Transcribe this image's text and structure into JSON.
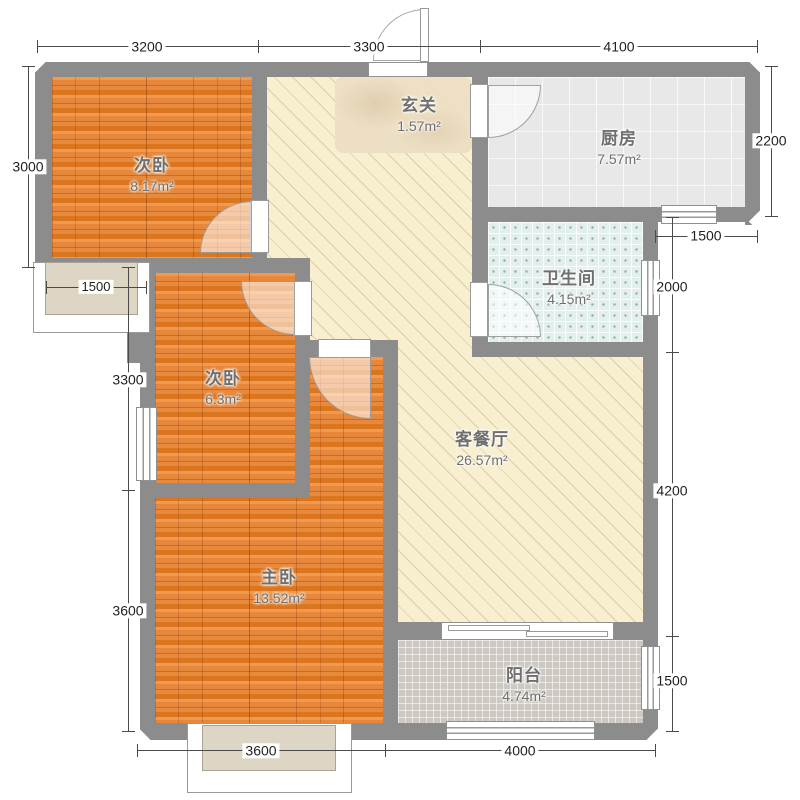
{
  "rooms": {
    "bedroom1": {
      "name": "次卧",
      "area": "8.17m²"
    },
    "hallway": {
      "name": "玄关",
      "area": "1.57m²"
    },
    "kitchen": {
      "name": "厨房",
      "area": "7.57m²"
    },
    "bathroom": {
      "name": "卫生间",
      "area": "4.15m²"
    },
    "bedroom2": {
      "name": "次卧",
      "area": "6.3m²"
    },
    "living": {
      "name": "客餐厅",
      "area": "26.57m²"
    },
    "master": {
      "name": "主卧",
      "area": "13.52m²"
    },
    "balcony": {
      "name": "阳台",
      "area": "4.74m²"
    }
  },
  "dimensions": {
    "top": [
      "3200",
      "3300",
      "4100"
    ],
    "left": [
      "3000",
      "3300",
      "3600"
    ],
    "right_kitchen": [
      "2200",
      "1500"
    ],
    "right": [
      "2000",
      "4200",
      "1500"
    ],
    "bottom": [
      "3600",
      "4000"
    ],
    "bay_window": [
      "1500"
    ]
  },
  "colors": {
    "wall": "#8c8c8c",
    "wood_floor": "#e0822f",
    "living_floor": "#f7efcf",
    "kitchen_tile": "#e8e8e8",
    "bath_tile": "#e3efed",
    "balcony_tile": "#cdc9c2",
    "bay_fill": "#ded6c5",
    "dimension_text": "#1f1f1f",
    "room_label_text": "#6f6f6f"
  }
}
